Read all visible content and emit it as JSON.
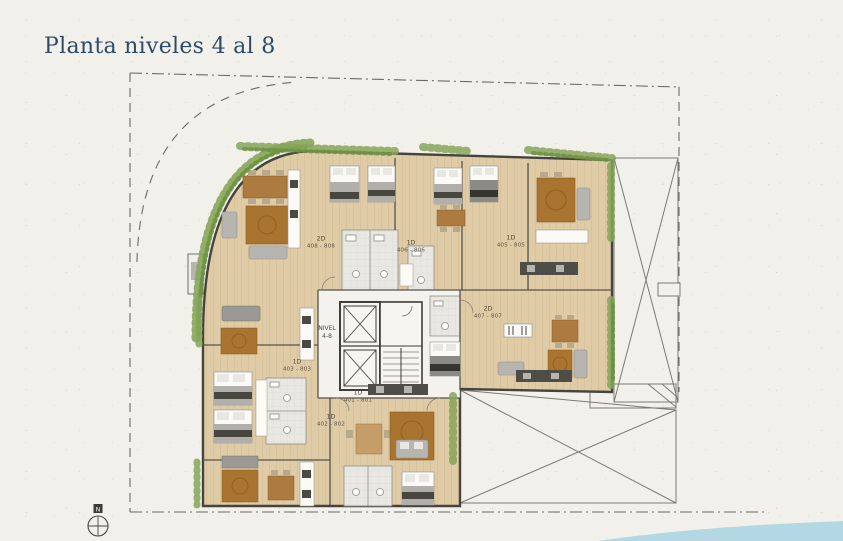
{
  "title": "Planta niveles 4 al 8",
  "core": {
    "line1": "NIVEL",
    "line2": "4-8"
  },
  "units": [
    {
      "type": "2D",
      "range": "408 - 808"
    },
    {
      "type": "1D",
      "range": "406 - 806"
    },
    {
      "type": "1D",
      "range": "405 - 805"
    },
    {
      "type": "2D",
      "range": "407 - 807"
    },
    {
      "type": "1D",
      "range": "403 - 803"
    },
    {
      "type": "1D",
      "range": "402 - 802"
    },
    {
      "type": "1D",
      "range": "401 - 801"
    }
  ],
  "compass": {
    "label": "N"
  },
  "colors": {
    "title_navy": "#2e4a66",
    "wood_floor": "#dfcba6",
    "wall": "#45443e",
    "vegetation": "#7fa050",
    "water": "#aed6e3",
    "paper": "#f1f0eb"
  }
}
